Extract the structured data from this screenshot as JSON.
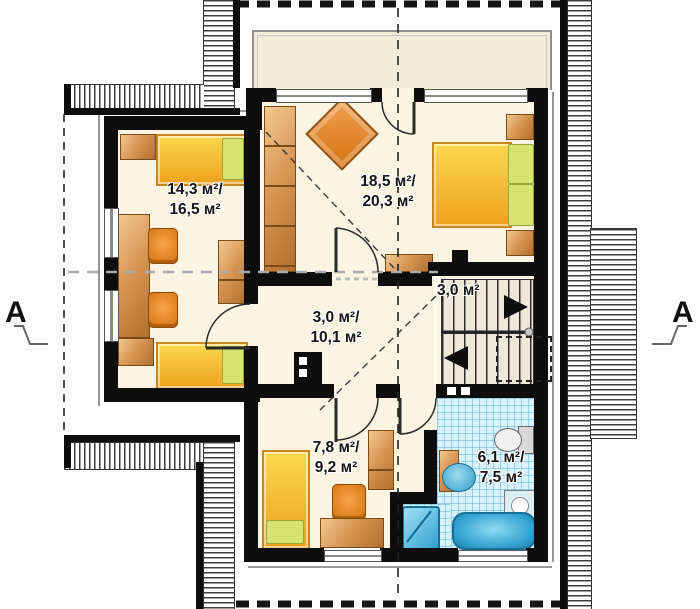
{
  "title": "attic floor plan",
  "rooms": {
    "child_room_left": {
      "line1": "14,3 м²/",
      "line2": "16,5 м²"
    },
    "master_bedroom": {
      "line1": "18,5 м²/",
      "line2": "20,3 м²"
    },
    "staircase": {
      "line1": "3,0 м²"
    },
    "hall": {
      "line1": "3,0 м²/",
      "line2": "10,1 м²"
    },
    "child_room_bottom": {
      "line1": "7,8 м²/",
      "line2": "9,2 м²"
    },
    "bathroom": {
      "line1": "6,1 м²/",
      "line2": "7,5 м²"
    }
  },
  "section_markers": {
    "left": "A",
    "right": "A"
  },
  "colors": {
    "wall": "#0d0d0d",
    "floor_cream": "#fbf4e2",
    "balcony_floor": "#f3ecd8",
    "tile_blue": "#d9f2fb",
    "wood": "#d89756",
    "bed_yellow": "#f6c33a",
    "pillow_green": "#d6e472",
    "chair_orange": "#e98a28",
    "fixture_blue": "#3aa7d6"
  }
}
